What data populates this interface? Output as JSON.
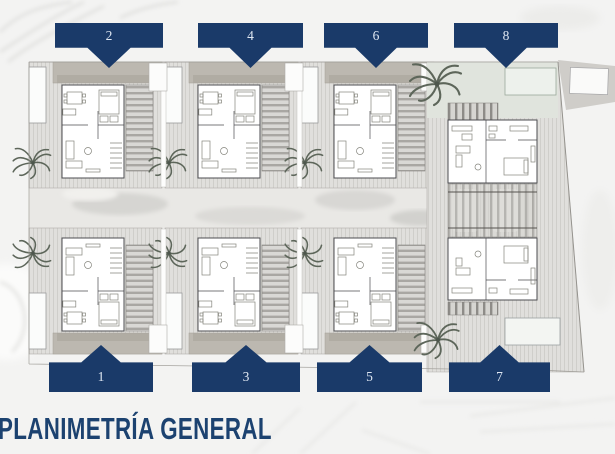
{
  "page": {
    "title": "PLANIMETRÍA GENERAL"
  },
  "banners": {
    "top": [
      {
        "label": "2"
      },
      {
        "label": "4"
      },
      {
        "label": "6"
      },
      {
        "label": "8"
      }
    ],
    "bottom": [
      {
        "label": "1"
      },
      {
        "label": "3"
      },
      {
        "label": "5"
      },
      {
        "label": "7"
      }
    ]
  },
  "colors": {
    "banner_navy": "#1a3a69",
    "title_navy": "#1c4270",
    "plan_paper": "#f3f3f2"
  }
}
